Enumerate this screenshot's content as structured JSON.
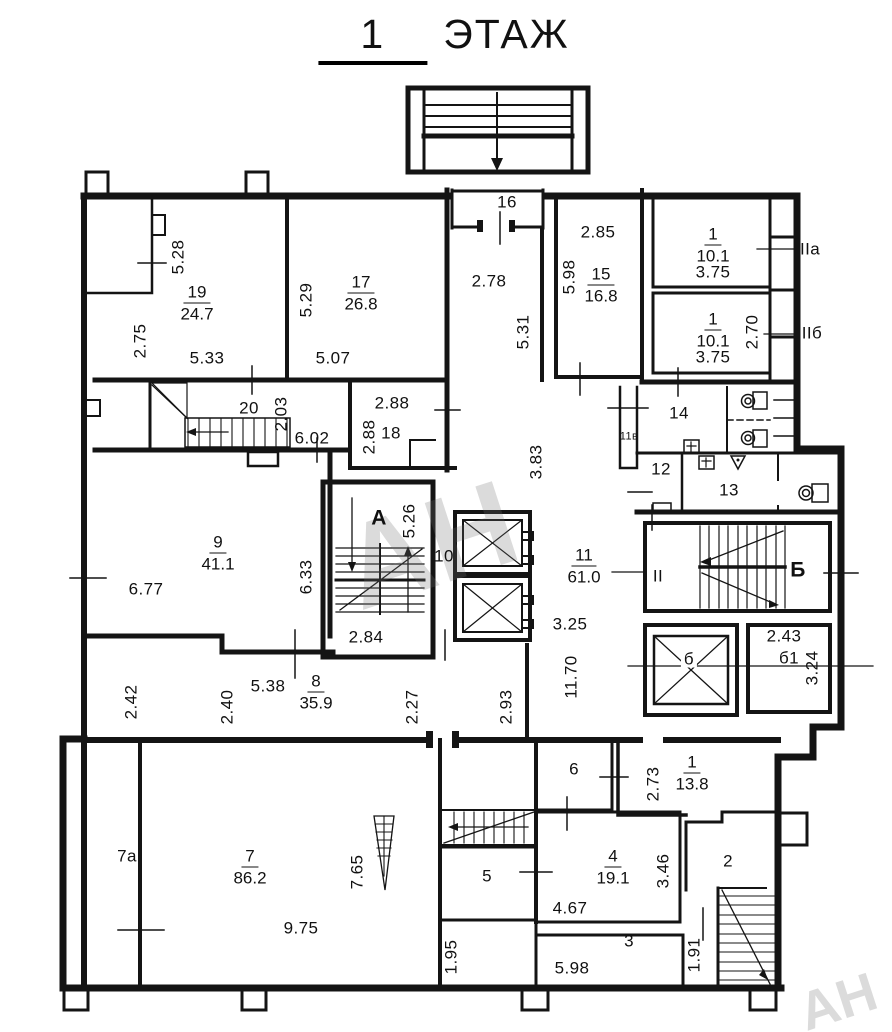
{
  "title_num": "1",
  "title_word": "ЭТАЖ",
  "watermark": "АН",
  "rooms": {
    "r19": {
      "num": "19",
      "area": "24.7"
    },
    "r17": {
      "num": "17",
      "area": "26.8"
    },
    "r15": {
      "num": "15",
      "area": "16.8"
    },
    "r1a": {
      "num": "1",
      "area": "10.1"
    },
    "r1b": {
      "num": "1",
      "area": "10.1"
    },
    "r9": {
      "num": "9",
      "area": "41.1"
    },
    "r11": {
      "num": "11",
      "area": "61.0"
    },
    "r8": {
      "num": "8",
      "area": "35.9"
    },
    "r7": {
      "num": "7",
      "area": "86.2"
    },
    "r4": {
      "num": "4",
      "area": "19.1"
    },
    "r1c": {
      "num": "1",
      "area": "13.8"
    }
  },
  "room_numbers": {
    "n20": "20",
    "n18": "18",
    "n16": "16",
    "n14": "14",
    "n12": "12",
    "n13": "13",
    "n10": "10",
    "n6": "6",
    "n5": "5",
    "n2": "2",
    "n3": "3",
    "n7a": "7а",
    "n11v": "11в",
    "nb": "б",
    "nb1": "б1",
    "stairA": "А",
    "stairB": "Б",
    "mII": "ІІ",
    "mIIa": "ІІа",
    "mIIb": "ІІб"
  },
  "dims": {
    "d528": "5.28",
    "d275": "2.75",
    "d533": "5.33",
    "d529": "5.29",
    "d507": "5.07",
    "d203": "2.03",
    "d602": "6.02",
    "d288a": "2.88",
    "d288b": "2.88",
    "d278": "2.78",
    "d531": "5.31",
    "d285": "2.85",
    "d598a": "5.98",
    "d375a": "3.75",
    "d375b": "3.75",
    "d270": "2.70",
    "d383": "3.83",
    "d526": "5.26",
    "d633": "6.33",
    "d677": "6.77",
    "d284": "2.84",
    "d325": "3.25",
    "d243": "2.43",
    "d324": "3.24",
    "d1170": "11.70",
    "d538": "5.38",
    "d242": "2.42",
    "d240": "2.40",
    "d227": "2.27",
    "d293": "2.93",
    "d273": "2.73",
    "d765": "7.65",
    "d975": "9.75",
    "d467": "4.67",
    "d346": "3.46",
    "d195": "1.95",
    "d598b": "5.98",
    "d191": "1.91"
  }
}
